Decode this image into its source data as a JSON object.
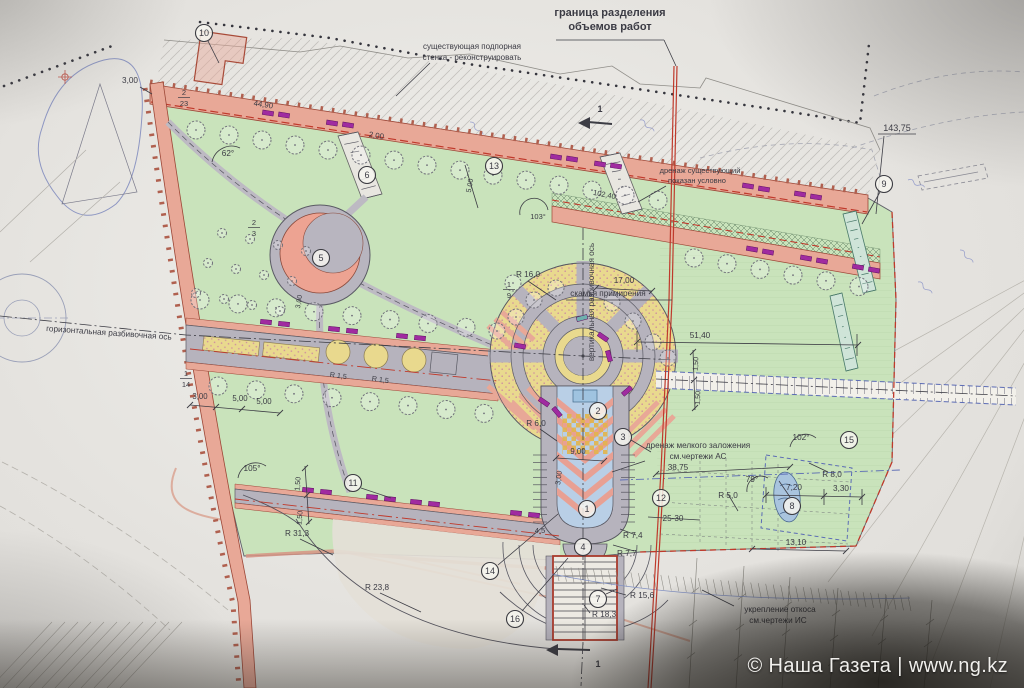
{
  "watermark": {
    "text": "© Наша Газета | www.ng.kz"
  },
  "colors": {
    "park_green": "#c9e3bb",
    "road_pink": "#e8a897",
    "paving_yellow": "#e9d98e",
    "path_gray": "#b6b3bd",
    "bench_magenta": "#a02ba0",
    "water_blue": "#b9cfe6",
    "boundary_red": "#bf3a2c",
    "axis_red_text": "#c2564c",
    "blueprint_blue": "#5b6bb5"
  },
  "labels": [
    {
      "t": "граница разделения",
      "x": 610,
      "y": 16,
      "s": 11,
      "w": "bold"
    },
    {
      "t": "объемов работ",
      "x": 610,
      "y": 30,
      "s": 11,
      "w": "bold"
    },
    {
      "t": "существующая подпорная",
      "x": 472,
      "y": 49,
      "s": 8
    },
    {
      "t": "стенка - реконструировать",
      "x": 472,
      "y": 60,
      "s": 8
    },
    {
      "t": "дренаж существующий",
      "x": 700,
      "y": 173,
      "s": 7.5
    },
    {
      "t": "показан условно",
      "x": 697,
      "y": 183,
      "s": 7.5
    },
    {
      "t": "143,75",
      "x": 897,
      "y": 131,
      "s": 9
    },
    {
      "t": "горизонтальная разбивочная ось",
      "x": 46,
      "y": 331,
      "s": 8.2,
      "c": "#c2564c",
      "r": 4,
      "a": "start"
    },
    {
      "t": "вертикальная разбивочная ось",
      "x": 594,
      "y": 302,
      "s": 8.2,
      "c": "#c2564c",
      "r": -90
    },
    {
      "t": "скамья примирения",
      "x": 608,
      "y": 296,
      "s": 8.2
    },
    {
      "t": "17,00",
      "x": 624,
      "y": 283,
      "s": 8.2
    },
    {
      "t": "R 16,0",
      "x": 528,
      "y": 277,
      "s": 8.2
    },
    {
      "t": "51,40",
      "x": 700,
      "y": 338,
      "s": 8.2
    },
    {
      "t": "102,40",
      "x": 604,
      "y": 197,
      "s": 7.5,
      "r": 11
    },
    {
      "t": "103°",
      "x": 538,
      "y": 219,
      "s": 7.5
    },
    {
      "t": "44,90",
      "x": 263,
      "y": 107,
      "s": 7.8,
      "r": 9
    },
    {
      "t": "2,00",
      "x": 376,
      "y": 138,
      "s": 7.8,
      "r": 9
    },
    {
      "t": "62°",
      "x": 228,
      "y": 156,
      "s": 8.2
    },
    {
      "t": "3,00",
      "x": 130,
      "y": 83,
      "s": 8.2
    },
    {
      "t": "105°",
      "x": 252,
      "y": 471,
      "s": 8.2
    },
    {
      "t": "R 31,3",
      "x": 297,
      "y": 536,
      "s": 8.2
    },
    {
      "t": "R 23,8",
      "x": 377,
      "y": 590,
      "s": 8.2
    },
    {
      "t": "R 18,3",
      "x": 592,
      "y": 617,
      "s": 8.2,
      "a": "start"
    },
    {
      "t": "R 15,6",
      "x": 630,
      "y": 598,
      "s": 8.2,
      "a": "start"
    },
    {
      "t": "R 7,7",
      "x": 617,
      "y": 556,
      "s": 8.2,
      "a": "start"
    },
    {
      "t": "R 7,4",
      "x": 623,
      "y": 538,
      "s": 8.2,
      "a": "start"
    },
    {
      "t": "4,5",
      "x": 540,
      "y": 533,
      "s": 7.6
    },
    {
      "t": "R 6,0",
      "x": 536,
      "y": 426,
      "s": 8.2
    },
    {
      "t": "9,00",
      "x": 578,
      "y": 454,
      "s": 7.8
    },
    {
      "t": "3,00",
      "x": 561,
      "y": 478,
      "s": 7.4,
      "r": -83
    },
    {
      "t": "R 5,0",
      "x": 728,
      "y": 498,
      "s": 8.2
    },
    {
      "t": "79°",
      "x": 752,
      "y": 482,
      "s": 8.2
    },
    {
      "t": "7,20",
      "x": 794,
      "y": 490,
      "s": 8.2
    },
    {
      "t": "3,30",
      "x": 841,
      "y": 491,
      "s": 8.2
    },
    {
      "t": "R 8,0",
      "x": 832,
      "y": 477,
      "s": 8.2
    },
    {
      "t": "102°",
      "x": 801,
      "y": 440,
      "s": 8.2
    },
    {
      "t": "38,75",
      "x": 678,
      "y": 470,
      "s": 8.2
    },
    {
      "t": "25-30",
      "x": 673,
      "y": 521,
      "s": 8.2
    },
    {
      "t": "13,10",
      "x": 796,
      "y": 545,
      "s": 8.2
    },
    {
      "t": "дренаж мелкого заложения",
      "x": 698,
      "y": 448,
      "s": 8.2
    },
    {
      "t": "см.чертежи АС",
      "x": 698,
      "y": 459,
      "s": 8.2
    },
    {
      "t": "укрепление откоса",
      "x": 780,
      "y": 612,
      "s": 8.2
    },
    {
      "t": "см.чертежи ИС",
      "x": 778,
      "y": 623,
      "s": 8.2
    },
    {
      "t": "1,50",
      "x": 300,
      "y": 484,
      "s": 7.2,
      "r": -85
    },
    {
      "t": "1,50",
      "x": 302,
      "y": 518,
      "s": 7.2,
      "r": -85
    },
    {
      "t": "1,50",
      "x": 698,
      "y": 364,
      "s": 7.2,
      "r": -87
    },
    {
      "t": "1,50",
      "x": 700,
      "y": 398,
      "s": 7.2,
      "r": -87
    },
    {
      "t": "5,00",
      "x": 472,
      "y": 186,
      "s": 7.2,
      "r": -80
    },
    {
      "t": "5,00",
      "x": 240,
      "y": 401,
      "s": 7.8
    },
    {
      "t": "5,00",
      "x": 264,
      "y": 404,
      "s": 7.8
    },
    {
      "t": "3,00",
      "x": 200,
      "y": 399,
      "s": 7.8
    },
    {
      "t": "R 1,5",
      "x": 338,
      "y": 378,
      "s": 7.2,
      "r": 8
    },
    {
      "t": "R 1,5",
      "x": 380,
      "y": 382,
      "s": 7.2,
      "r": 8
    },
    {
      "t": "3,00",
      "x": 301,
      "y": 302,
      "s": 7,
      "r": -80
    },
    {
      "t": "1",
      "x": 600,
      "y": 112,
      "s": 9,
      "w": "bold"
    },
    {
      "t": "1",
      "x": 598,
      "y": 667,
      "s": 9,
      "w": "bold"
    }
  ],
  "fractions": [
    {
      "num": "2",
      "den": "23",
      "x": 184,
      "y": 95
    },
    {
      "num": "1",
      "den": "9",
      "x": 509,
      "y": 287
    },
    {
      "num": "1",
      "den": "14",
      "x": 186,
      "y": 376
    },
    {
      "num": "2",
      "den": "3",
      "x": 254,
      "y": 225
    }
  ],
  "callouts": [
    {
      "n": "1",
      "x": 587,
      "y": 509
    },
    {
      "n": "2",
      "x": 598,
      "y": 411
    },
    {
      "n": "3",
      "x": 623,
      "y": 437
    },
    {
      "n": "4",
      "x": 583,
      "y": 547
    },
    {
      "n": "5",
      "x": 321,
      "y": 258
    },
    {
      "n": "6",
      "x": 367,
      "y": 175
    },
    {
      "n": "7",
      "x": 598,
      "y": 599
    },
    {
      "n": "8",
      "x": 792,
      "y": 506
    },
    {
      "n": "9",
      "x": 884,
      "y": 184
    },
    {
      "n": "10",
      "x": 204,
      "y": 33
    },
    {
      "n": "11",
      "x": 353,
      "y": 483
    },
    {
      "n": "12",
      "x": 661,
      "y": 498
    },
    {
      "n": "13",
      "x": 494,
      "y": 166
    },
    {
      "n": "14",
      "x": 490,
      "y": 571
    },
    {
      "n": "15",
      "x": 849,
      "y": 440
    },
    {
      "n": "16",
      "x": 515,
      "y": 619
    }
  ]
}
